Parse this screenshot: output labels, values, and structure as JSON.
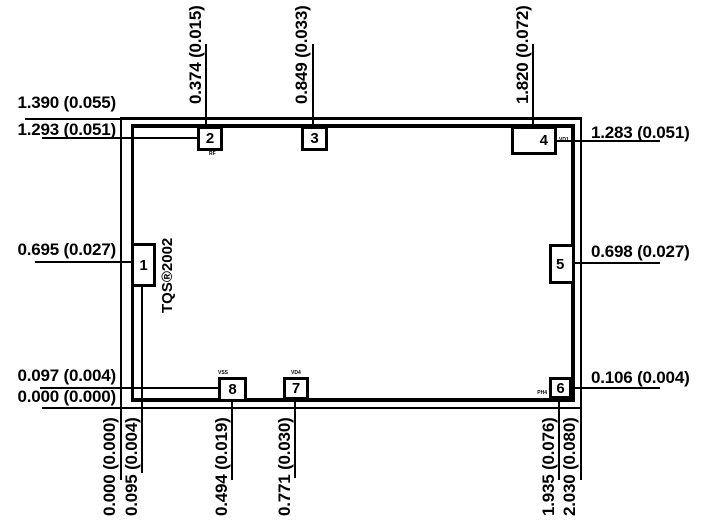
{
  "drawing": {
    "brand_text": "TQS®2002"
  },
  "pads": [
    {
      "number": "1",
      "pin": ""
    },
    {
      "number": "2",
      "pin": "RF"
    },
    {
      "number": "3",
      "pin": "VSS"
    },
    {
      "number": "4",
      "pin": "VD1"
    },
    {
      "number": "5",
      "pin": ""
    },
    {
      "number": "6",
      "pin": "PH4"
    },
    {
      "number": "7",
      "pin": "VD4"
    },
    {
      "number": "8",
      "pin": "VSS"
    }
  ],
  "dims": {
    "left": [
      "1.390 (0.055)",
      "1.293 (0.051)",
      "0.695 (0.027)",
      "0.097 (0.004)",
      "0.000 (0.000)"
    ],
    "right": [
      "1.283 (0.051)",
      "0.698 (0.027)",
      "0.106 (0.004)"
    ],
    "top": [
      "0.374 (0.015)",
      "0.849 (0.033)",
      "1.820 (0.072)"
    ],
    "bottom": [
      "0.000 (0.000)",
      "0.095 (0.004)",
      "0.494 (0.019)",
      "0.771 (0.030)",
      "1.935 (0.076)",
      "2.030 (0.080)"
    ]
  }
}
